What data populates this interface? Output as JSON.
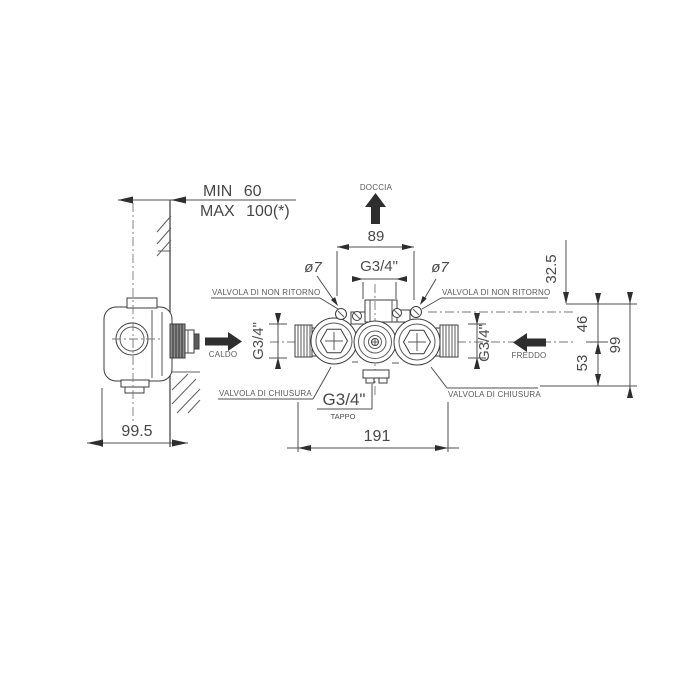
{
  "side_view": {
    "wall_min": "MIN 60",
    "wall_max": "MAX 100(*)",
    "depth": "99.5"
  },
  "front_view": {
    "outlet": "DOCCIA",
    "centers_width": "89",
    "top_thread": "G3/4\"",
    "screw_hole_left": "ø7",
    "screw_hole_right": "ø7",
    "check_valve_left": "VALVOLA DI NON RITORNO",
    "check_valve_right": "VALVOLA DI NON RITORNO",
    "hot": "CALDO",
    "cold": "FREDDO",
    "thread_left": "G3/4\"",
    "thread_right": "G3/4\"",
    "shutoff_left": "VALVOLA DI CHIUSURA",
    "shutoff_right": "VALVOLA DI CHIUSURA",
    "plug_thread": "G3/4\"",
    "plug": "TAPPO",
    "total_width": "191",
    "h_top": "32.5",
    "h_mid": "46",
    "h_bottom": "53",
    "h_total": "99"
  }
}
